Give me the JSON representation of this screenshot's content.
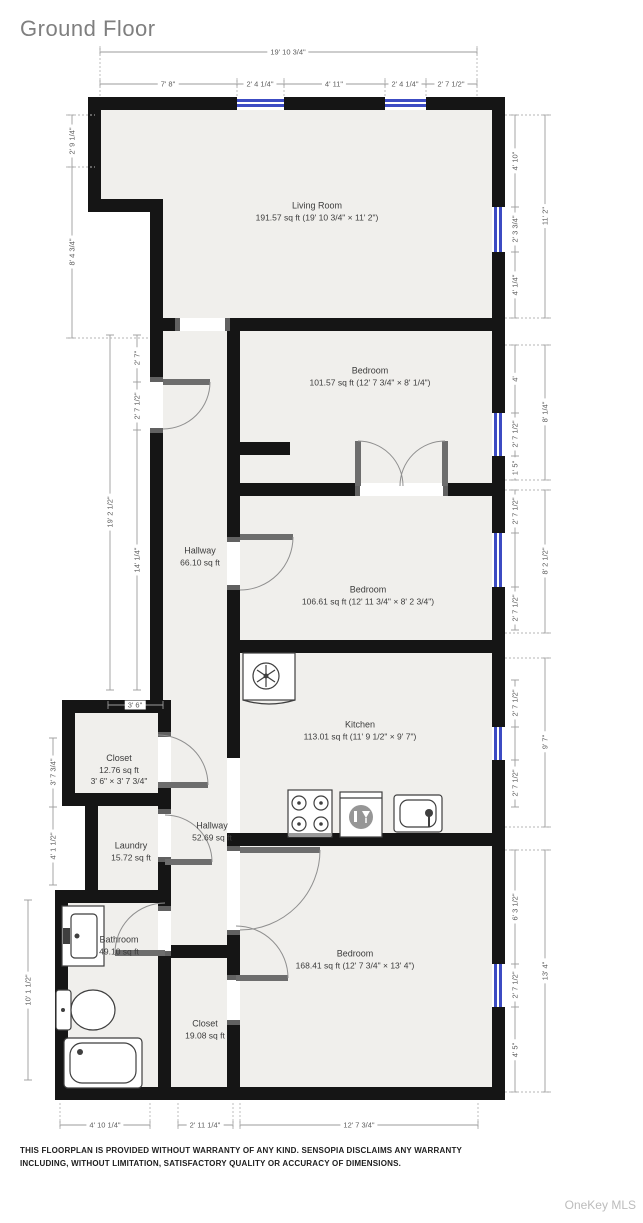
{
  "header": {
    "title": "Ground Floor"
  },
  "footer": {
    "disclaimer_line1": "THIS FLOORPLAN IS PROVIDED WITHOUT WARRANTY OF ANY KIND. SENSOPIA DISCLAIMS ANY WARRANTY",
    "disclaimer_line2": "INCLUDING, WITHOUT LIMITATION, SATISFACTORY QUALITY OR ACCURACY OF DIMENSIONS.",
    "watermark": "OneKey MLS"
  },
  "colors": {
    "wall": "#151515",
    "room_fill": "#f0efec",
    "window": "#3c4bc3",
    "dimension": "#9b9b9b"
  },
  "rooms": {
    "living_room": {
      "name": "Living Room",
      "detail": "191.57 sq ft (19' 10 3/4\" × 11' 2\")"
    },
    "bedroom1": {
      "name": "Bedroom",
      "detail": "101.57 sq ft (12' 7 3/4\" × 8' 1/4\")"
    },
    "hallway1": {
      "name": "Hallway",
      "detail": "66.10 sq ft"
    },
    "bedroom2": {
      "name": "Bedroom",
      "detail": "106.61 sq ft (12' 11 3/4\" × 8' 2 3/4\")"
    },
    "kitchen": {
      "name": "Kitchen",
      "detail": "113.01 sq ft (11' 9 1/2\" × 9' 7\")"
    },
    "closet1": {
      "name": "Closet",
      "detail": "12.76 sq ft",
      "detail2": "3' 6\" × 3' 7 3/4\""
    },
    "hallway2": {
      "name": "Hallway",
      "detail": "52.69 sq ft"
    },
    "laundry": {
      "name": "Laundry",
      "detail": "15.72 sq ft"
    },
    "bathroom": {
      "name": "Bathroom",
      "detail": "49.10 sq ft"
    },
    "closet2": {
      "name": "Closet",
      "detail": "19.08 sq ft"
    },
    "bedroom3": {
      "name": "Bedroom",
      "detail": "168.41 sq ft (12' 7 3/4\" × 13' 4\")"
    }
  },
  "dims": {
    "top_total": "19' 10 3/4\"",
    "top_1": "7' 8\"",
    "top_2": "2' 4 1/4\"",
    "top_3": "4' 11\"",
    "top_4": "2' 4 1/4\"",
    "top_5": "2' 7 1/2\"",
    "left_1": "2' 9 1/4\"",
    "left_2": "8' 4 3/4\"",
    "left_3": "2' 7\"",
    "left_4": "2' 7 1/2\"",
    "left_5": "14' 1/4\"",
    "left_mid_total": "19' 2 1/2\"",
    "left_6": "3' 6\"",
    "left_7": "3' 7 3/4\"",
    "left_8": "4' 1 1/2\"",
    "left_9": "10' 1 1/2\"",
    "right_lr_1": "4' 10\"",
    "right_lr_2": "2' 3 3/4\"",
    "right_lr_3": "4' 1/4\"",
    "right_lr_total": "11' 2\"",
    "right_br1_1": "4'",
    "right_br1_2": "2' 7 1/2\"",
    "right_br1_3": "1' 5\"",
    "right_br1_total": "8' 1/4\"",
    "right_br2_1": "2' 7 1/2\"",
    "right_br2_2": "2' 7 1/2\"",
    "right_br2_total": "8' 2 1/2\"",
    "right_k_1": "2' 7 1/2\"",
    "right_k_2": "2' 7 1/2\"",
    "right_k_total": "9' 7\"",
    "right_br3_1": "6' 3 1/2\"",
    "right_br3_2": "2' 7 1/2\"",
    "right_br3_3": "4' 5\"",
    "right_br3_total": "13' 4\"",
    "bottom_1": "4' 10 1/4\"",
    "bottom_2": "2' 11 1/4\"",
    "bottom_3": "12' 7 3/4\""
  }
}
